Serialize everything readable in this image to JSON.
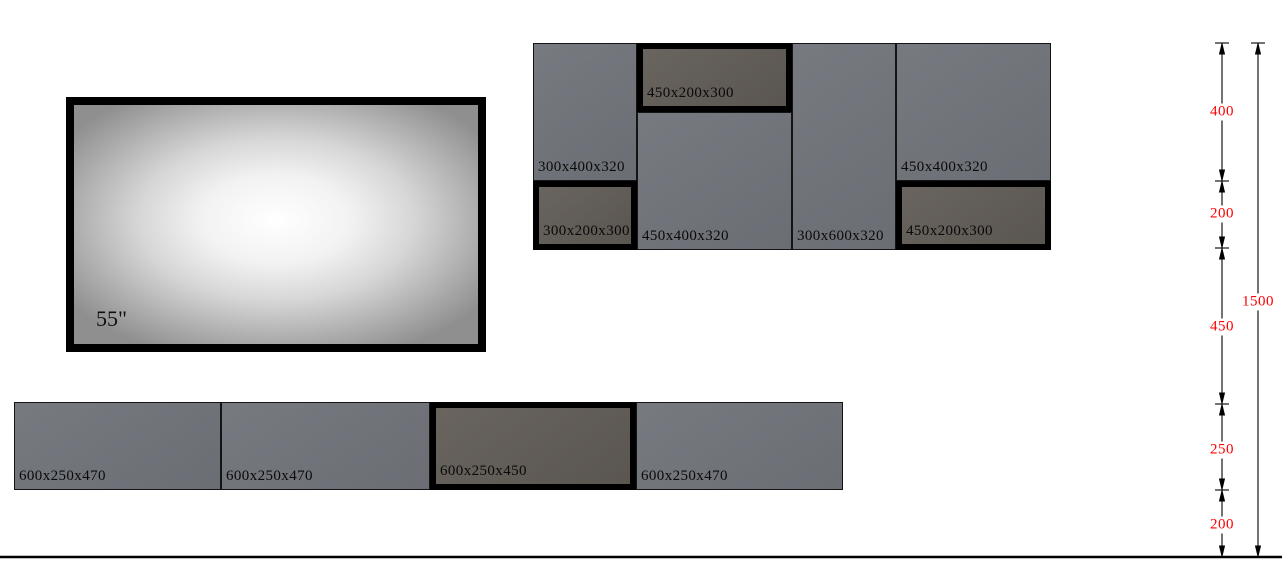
{
  "tv": {
    "size_label": "55\""
  },
  "cabinets": {
    "wall_row": [
      {
        "label": "300x400x320",
        "highlighted": false
      },
      {
        "label": "300x200x300",
        "highlighted": true
      },
      {
        "label": "450x200x300",
        "highlighted": true
      },
      {
        "label": "450x400x320",
        "highlighted": false
      },
      {
        "label": "300x600x320",
        "highlighted": false
      },
      {
        "label": "450x400x320",
        "highlighted": false
      },
      {
        "label": "450x200x300",
        "highlighted": true
      }
    ],
    "base_row": [
      {
        "label": "600x250x470",
        "highlighted": false
      },
      {
        "label": "600x250x470",
        "highlighted": false
      },
      {
        "label": "600x250x450",
        "highlighted": true
      },
      {
        "label": "600x250x470",
        "highlighted": false
      }
    ]
  },
  "dimensions": {
    "segments": [
      "400",
      "200",
      "450",
      "250",
      "200"
    ],
    "total": "1500",
    "color": "#ff0000"
  },
  "colors": {
    "cabinet_gray": "#71757b",
    "cabinet_highlight_fill": "#615c56",
    "highlight_border": "#000000",
    "dimension_red": "#ff0000",
    "background": "#ffffff"
  }
}
